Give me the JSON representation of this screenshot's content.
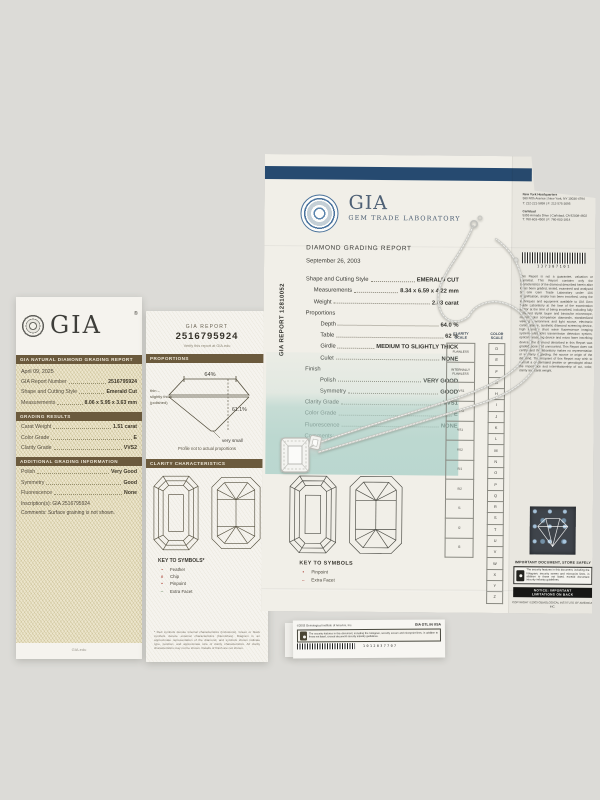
{
  "colors": {
    "navy": "#264a70",
    "brown": "#6b5a3d",
    "teal": "#bcd8d0",
    "cream": "#ece5cc"
  },
  "left_cert": {
    "brand": "GIA",
    "reg": "®",
    "header": "GIA NATURAL DIAMOND GRADING REPORT",
    "date": "April 09, 2025",
    "fields": [
      {
        "label": "GIA Report Number",
        "value": "2516795924"
      },
      {
        "label": "Shape and Cutting Style",
        "value": "Emerald Cut"
      },
      {
        "label": "Measurements",
        "value": "8.06 x 5.95 x 3.63 mm"
      }
    ],
    "results_title": "GRADING RESULTS",
    "results": [
      {
        "label": "Carat Weight",
        "value": "1.51 carat"
      },
      {
        "label": "Color Grade",
        "value": "E"
      },
      {
        "label": "Clarity Grade",
        "value": "VVS2"
      }
    ],
    "additional_title": "ADDITIONAL GRADING INFORMATION",
    "additional": [
      {
        "label": "Polish",
        "value": "Very Good"
      },
      {
        "label": "Symmetry",
        "value": "Good"
      },
      {
        "label": "Fluorescence",
        "value": "None"
      }
    ],
    "inscription": "Inscription(s): GIA 2516795924",
    "comments": "Comments: Surface graining is not shown.",
    "footer": "GIA.edu"
  },
  "strip": {
    "report_label": "GIA REPORT",
    "report_number": "2516795924",
    "verify": "Verify this report at GIA.edu",
    "proportions_title": "PROPORTIONS",
    "profile": {
      "table": "64%",
      "depth": "61.1%",
      "girdle1": "thin –",
      "girdle2": "slightly thick",
      "girdle3": "(polished)",
      "culet": "very small",
      "caption": "Profile not to actual proportions"
    },
    "clarity_title": "CLARITY CHARACTERISTICS",
    "key_title": "KEY TO SYMBOLS*",
    "key_items": [
      {
        "sym": "~",
        "label": "Feather"
      },
      {
        "sym": "∧",
        "label": "Chip"
      },
      {
        "sym": "•",
        "label": "Pinpoint"
      },
      {
        "sym": "–",
        "label": "Extra Facet"
      }
    ],
    "footnote": "* Red symbols denote internal characteristics (inclusions). Green or black symbols denote external characteristics (blemishes). Diagram is an approximate representation of the diamond, and symbols shown indicate type, position, and approximate size of clarity characteristics. All clarity characteristics may not be shown. Details of finish are not shown."
  },
  "report": {
    "brand": "GIA",
    "brand_sub": "Gem Trade Laboratory",
    "title": "DIAMOND GRADING REPORT",
    "side_number": "GIA REPORT 12810052",
    "date": "September 26, 2003",
    "shape_row": {
      "label": "Shape and Cutting Style",
      "value": "EMERALD CUT"
    },
    "shape_sub": [
      {
        "label": "Measurements",
        "value": "8.34 x 6.59 x 4.22 mm"
      },
      {
        "label": "Weight",
        "value": "2.03 carat"
      }
    ],
    "proportions_label": "Proportions",
    "proportions": [
      {
        "label": "Depth",
        "value": "64.0 %"
      },
      {
        "label": "Table",
        "value": "62 %"
      },
      {
        "label": "Girdle",
        "value": "MEDIUM TO SLIGHTLY THICK"
      },
      {
        "label": "Culet",
        "value": "NONE"
      }
    ],
    "finish_label": "Finish",
    "finish": [
      {
        "label": "Polish",
        "value": "VERY GOOD"
      },
      {
        "label": "Symmetry",
        "value": "GOOD"
      }
    ],
    "grades": [
      {
        "label": "Clarity Grade",
        "value": "VVS1"
      },
      {
        "label": "Color Grade",
        "value": "E"
      },
      {
        "label": "Fluorescence",
        "value": "NONE"
      }
    ],
    "comments_label": "Comments:",
    "comments_value": "NONE",
    "clarity_scale_title": "CLARITY\nSCALE",
    "clarity_scale": [
      "FLAWLESS",
      "INTERNALLY FLAWLESS",
      "VVS1",
      "VVS2",
      "VS1",
      "VS2",
      "SI1",
      "SI2",
      "I1",
      "I2",
      "I3"
    ],
    "color_scale_title": "COLOR\nSCALE",
    "color_scale": [
      "D",
      "E",
      "F",
      "G",
      "H",
      "I",
      "J",
      "K",
      "L",
      "M",
      "N",
      "O",
      "P",
      "Q",
      "R",
      "S",
      "T",
      "U",
      "V",
      "W",
      "X",
      "Y",
      "Z"
    ],
    "key_title": "KEY TO SYMBOLS",
    "key_items": [
      {
        "sym": "•",
        "label": "Pinpoint"
      },
      {
        "sym": "–",
        "label": "Extra Facet"
      }
    ],
    "address_ny": [
      "New York Headquarters",
      "580 Fifth Avenue | New York, NY 10036-4794",
      "T: 212-221-5858 | F: 212-575-3095"
    ],
    "address_ca": [
      "Carlsbad",
      "5355 Armada Drive | Carlsbad, CA 92008-4602",
      "T: 760-603-4500 | F: 760-603-1814"
    ],
    "barcode_number": "137307101",
    "legal": "This Report is not a guarantee, valuation or appraisal. This Report contains only the characteristics of the diamond described herein after it has been graded, tested, examined and analyzed by GIA Gem Trade Laboratory under 10X magnification, and/or has been inscribed, using the techniques and equipment available to GIA Gem Trade Laboratory at the time of the examination and/or at the time of being inscribed, including fully corrected triplet loupe and binocular microscope, master color comparison diamonds, standardized viewing environment and light source, electronic carat balance, synthetic diamond screening device, high intensity short wave fluorescence imaging system, ultraviolet transmission detection system, optical measuring device and micro laser inscribing device. The diamond described in this Report was graded loose and unmounted. This Report does not certify, and the laboratory makes no representation or warranty regarding, the source or origin of the diamond. The recipient of this Report may wish to consult a credentialed jeweler or gemologist about the importance and interrelationship of cut, color, clarity and carat weight.",
    "important": "IMPORTANT DOCUMENT, STORE SAFELY",
    "security": "The security features in this document, including the hologram, security screen and microprint lines, in addition to those not listed, exceed document security industry guidelines.",
    "notice1": "NOTICE: IMPORTANT",
    "notice2": "LIMITATIONS ON BACK",
    "copyright": "COPYRIGHT ©2003 GEMOLOGICAL INSTITUTE OF AMERICA, INC."
  },
  "card": {
    "copyright": "©2003 Gemological Institute of America, Inc.",
    "code": "GIA GTL IN USA",
    "security": "The security features in this document, including the hologram, security screen and microprint lines, in addition to those not listed, exceed document security industry guidelines.",
    "barcode_number": "1012037707"
  }
}
